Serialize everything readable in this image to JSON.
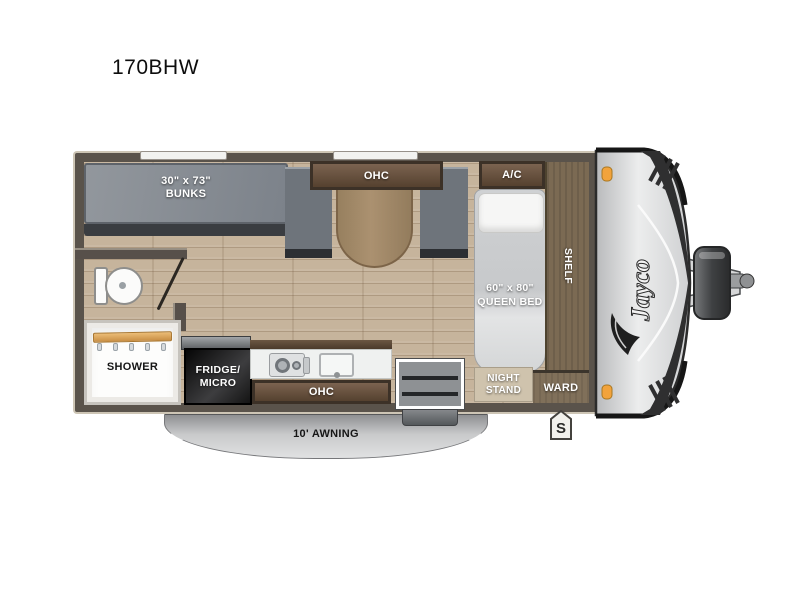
{
  "title": "170BHW",
  "brand": "Jayco",
  "interior": {
    "bunks": {
      "size": "30\" x 73\"",
      "name": "BUNKS"
    },
    "dinette_ohc": "OHC",
    "ac": "A/C",
    "queen_bed": {
      "size": "60\" x 80\"",
      "name": "QUEEN BED"
    },
    "shelf": "SHELF",
    "ward": "WARD",
    "night_stand": "NIGHT\nSTAND",
    "shower": "SHOWER",
    "fridge": "FRIDGE/\nMICRO",
    "kitchen_ohc": "OHC"
  },
  "exterior": {
    "awning": "10' AWNING",
    "curbside_marker": "S"
  },
  "icons": {
    "bird": "jayco-bird-logo",
    "marker_lights": "amber-clearance-light",
    "hitch": "a-frame-tongue-propane-coupler",
    "toilet": "toilet-top-view",
    "stove": "two-burner-cooktop",
    "sink": "kitchen-sink"
  },
  "colors": {
    "wall": "#5a534b",
    "floor_wood": "#c6b49c",
    "cabinet_wood": "#6b5540",
    "shelf_wood": "#7b6a53",
    "bunk_mattress": "#878c93",
    "bench": "#6e747b",
    "table": "#a48a6a",
    "bed_mattress": "#d6d8da",
    "fridge": "#1b1b1b",
    "awning": "#c0c1c3",
    "cap_silver": "#d9dadc",
    "graphic_dark": "#2f2f30",
    "marker_light": "#f2a33c",
    "shower_rod": "#ddab62"
  }
}
